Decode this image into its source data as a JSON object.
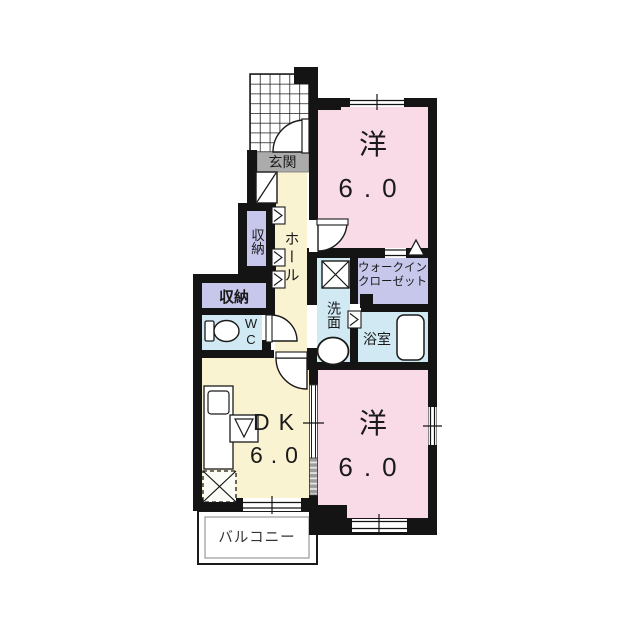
{
  "rooms": {
    "entrance": "玄関",
    "hall": "ホール",
    "storage_upper": "収納",
    "storage_lower": "収納",
    "wc": "WC",
    "washroom": "洗面",
    "bathroom": "浴室",
    "walk_in_closet_line1": "ウォークイン",
    "walk_in_closet_line2": "クローゼット",
    "dining_kitchen": {
      "label": "DK",
      "size": "6.0"
    },
    "western_room_top": {
      "label": "洋",
      "size": "6.0"
    },
    "western_room_bottom": {
      "label": "洋",
      "size": "6.0"
    },
    "balcony": "バルコニー"
  },
  "colors": {
    "wall": "#141414",
    "room_pink": "#f8dbe7",
    "room_yellow": "#faf3d2",
    "room_lavender": "#c7c7ec",
    "room_blue": "#d0e9f2",
    "entrance_gray": "#ababab",
    "balcony_white": "#ffffff"
  }
}
